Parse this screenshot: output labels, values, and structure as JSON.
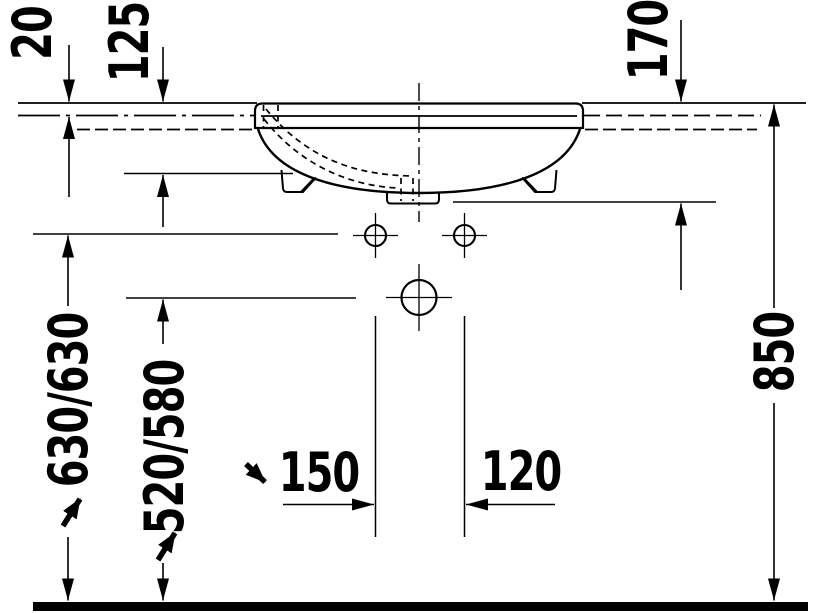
{
  "drawing": {
    "type": "washbasin-installation-front-elevation",
    "colors": {
      "line": "#000000",
      "background": "#ffffff"
    },
    "dimensions": {
      "rim_above_counter": "20",
      "rim_to_basin_bottom": "125",
      "rim_to_underside": "170",
      "supply_height": "630/630",
      "drain_height": "520/580",
      "supply_spacing": "150",
      "drain_spacing": "120",
      "rim_height": "850"
    }
  }
}
